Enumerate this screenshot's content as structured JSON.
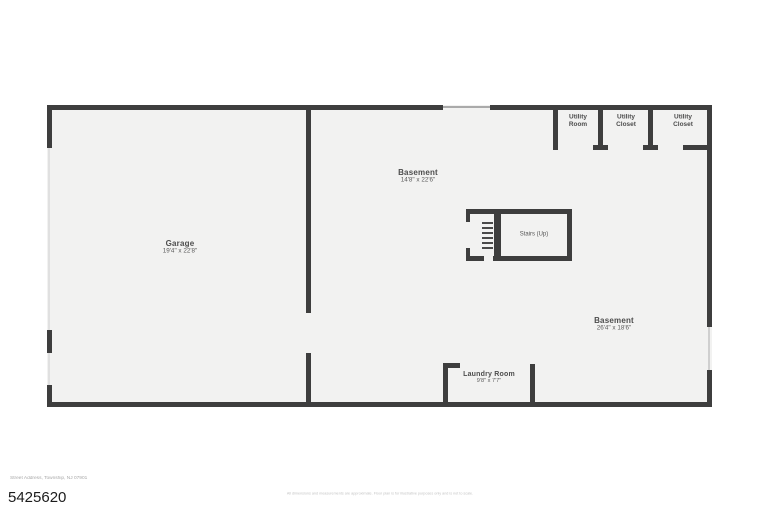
{
  "floorplan": {
    "colors": {
      "wall": "#3e3e3e",
      "floor_fill": "#f2f2f1"
    },
    "rooms": [
      {
        "label": "Garage",
        "dims": "19'4\" x 22'8\""
      },
      {
        "label": "Basement",
        "dims": "14'8\" x 22'6\""
      },
      {
        "label": "Basement",
        "dims": "26'4\" x 18'6\""
      },
      {
        "label": "Laundry Room",
        "dims": "9'8\" x 7'7\""
      },
      {
        "label": "Stairs (Up)"
      },
      {
        "label": "Utility Room"
      },
      {
        "label": "Utility Closet"
      },
      {
        "label": "Utility Closet"
      }
    ]
  },
  "footer": {
    "listing_number": "5425620",
    "address_line": "Street Address, Township, NJ 07901",
    "disclaimer": "All dimensions and measurements are approximate. Floor plan is for illustrative purposes only and is not to scale."
  }
}
